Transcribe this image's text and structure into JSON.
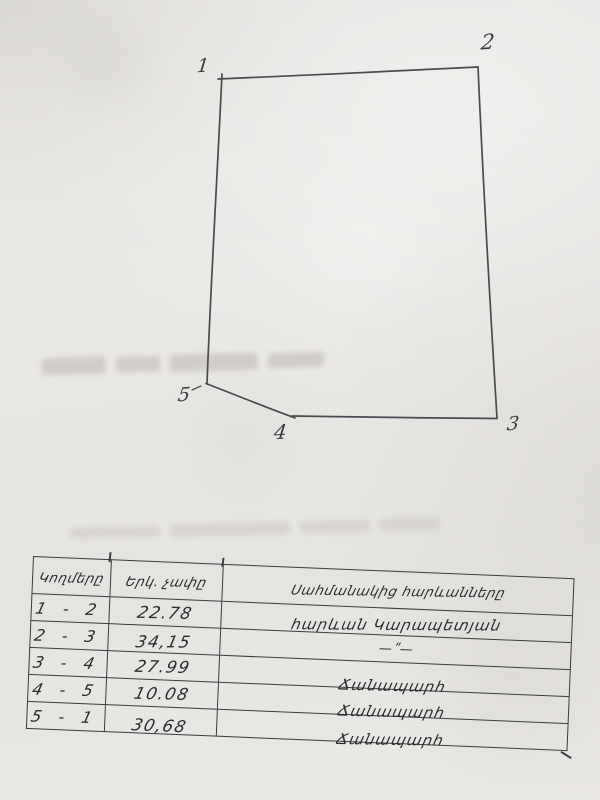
{
  "sketch": {
    "vertex_labels": [
      "1",
      "2",
      "3",
      "4",
      "5"
    ],
    "shape": "five-sided land parcel outline"
  },
  "table": {
    "headers": {
      "sides": "Կողմերը",
      "length": "Երկ. չափը",
      "neighbors": "Սահմանակից հարևանները"
    },
    "rows": [
      {
        "pair": "1 - 2",
        "length": "22.78",
        "neighbor": "հարևան Կարապետյան"
      },
      {
        "pair": "2 - 3",
        "length": "34,15",
        "neighbor": "—ʺ—"
      },
      {
        "pair": "3 - 4",
        "length": "27.99",
        "neighbor": "Ճանապարհ"
      },
      {
        "pair": "4 - 5",
        "length": "10.08",
        "neighbor": "Ճանապարհ"
      },
      {
        "pair": "5 - 1",
        "length": "30,68",
        "neighbor": "Ճանապարհ"
      }
    ]
  },
  "colors": {
    "paper": "#e9e7e4",
    "pencil": "#4a4a50",
    "ink": "#2c2c31",
    "table_line": "#3b3b41",
    "ghost": "#c8c5c0"
  }
}
